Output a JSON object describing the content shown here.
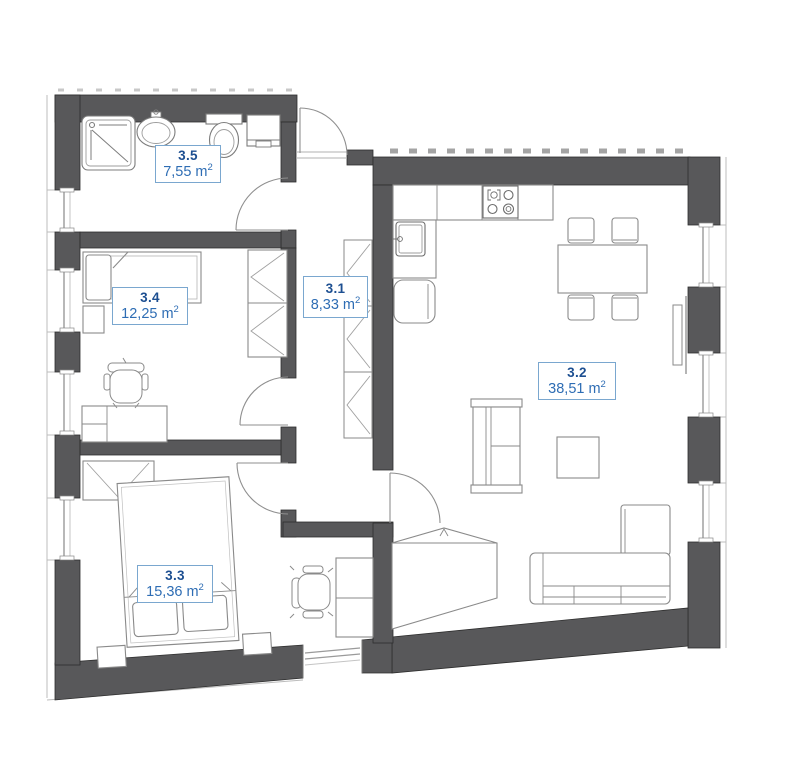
{
  "plan": {
    "colors": {
      "wall": "#58585a",
      "wall_outline": "#2e2e2e",
      "furniture_line": "#8a8a8a",
      "glazing": "#9a9a9a",
      "label_border": "#7aa7cf",
      "label_id_text": "#1d4f91",
      "label_area_text": "#2e6db4",
      "background": "#ffffff"
    },
    "rooms": [
      {
        "id": "3.5",
        "area_number": "7,55",
        "area_unit": "m",
        "area_exp": "2",
        "type": "bathroom",
        "fixtures": [
          "shower",
          "washbasin",
          "toilet",
          "cabinet"
        ]
      },
      {
        "id": "3.4",
        "area_number": "12,25",
        "area_unit": "m",
        "area_exp": "2",
        "type": "bedroom",
        "fixtures": [
          "single-bed",
          "nightstand",
          "desk",
          "office-chair",
          "wardrobe"
        ]
      },
      {
        "id": "3.1",
        "area_number": "8,33",
        "area_unit": "m",
        "area_exp": "2",
        "type": "hallway",
        "fixtures": [
          "wardrobe-closets",
          "entrance-door"
        ]
      },
      {
        "id": "3.2",
        "area_number": "38,51",
        "area_unit": "m",
        "area_exp": "2",
        "type": "living-room-kitchen",
        "fixtures": [
          "kitchen-counter",
          "stove",
          "kitchen-sink",
          "fridge",
          "dining-table",
          "dining-chairs",
          "shelf-unit",
          "coffee-table",
          "corner-sofa",
          "corner-wardrobe",
          "radiator"
        ]
      },
      {
        "id": "3.3",
        "area_number": "15,36",
        "area_unit": "m",
        "area_exp": "2",
        "type": "bedroom",
        "fixtures": [
          "double-bed",
          "nightstands",
          "wardrobe",
          "desk",
          "office-chair"
        ]
      }
    ]
  }
}
